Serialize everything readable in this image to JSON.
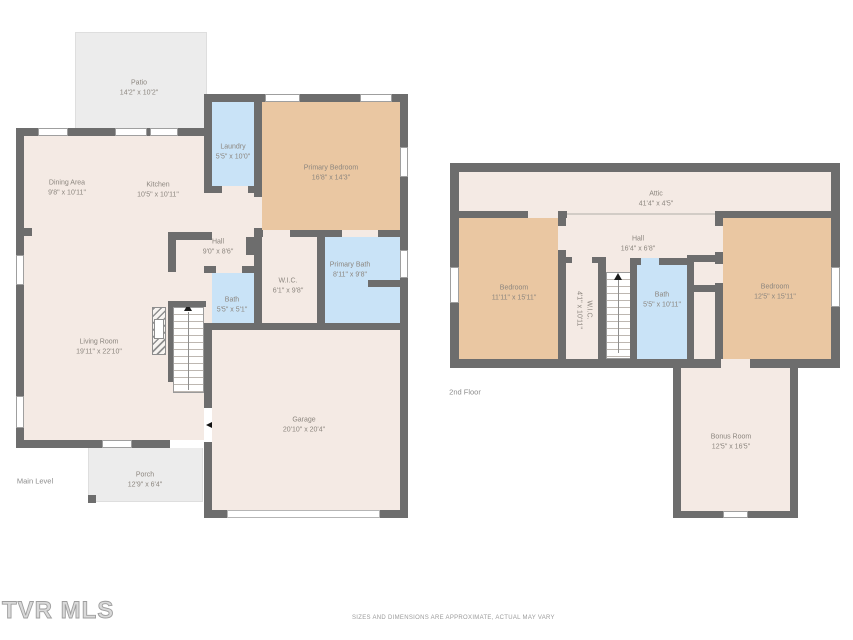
{
  "page": {
    "watermark": "TVR MLS",
    "disclaimer": "SIZES AND DIMENSIONS ARE APPROXIMATE, ACTUAL MAY VARY"
  },
  "colors": {
    "wall": "#6d6d6d",
    "floor": "#f4eae4",
    "bedroom_tan": "#eac7a2",
    "bath_blue": "#c9e3f7",
    "outdoor_gray": "#ececec",
    "label_text": "#8c867f"
  },
  "main_level": {
    "label": "Main Level",
    "rooms": [
      {
        "name": "Patio",
        "dims": "14'2\" x 10'2\""
      },
      {
        "name": "Dining Area",
        "dims": "9'8\" x 10'11\""
      },
      {
        "name": "Kitchen",
        "dims": "10'5\" x 10'11\""
      },
      {
        "name": "Laundry",
        "dims": "5'5\" x 10'0\""
      },
      {
        "name": "Primary Bedroom",
        "dims": "16'8\" x 14'3\""
      },
      {
        "name": "Hall",
        "dims": "9'0\" x 8'6\""
      },
      {
        "name": "W.I.C.",
        "dims": "6'1\" x 9'8\""
      },
      {
        "name": "Primary Bath",
        "dims": "8'11\" x 9'8\""
      },
      {
        "name": "Bath",
        "dims": "5'5\" x 5'1\""
      },
      {
        "name": "Living Room",
        "dims": "19'11\" x 22'10\""
      },
      {
        "name": "Garage",
        "dims": "20'10\" x 20'4\""
      },
      {
        "name": "Porch",
        "dims": "12'9\" x 6'4\""
      }
    ]
  },
  "second_floor": {
    "label": "2nd Floor",
    "rooms": [
      {
        "name": "Attic",
        "dims": "41'4\" x 4'5\""
      },
      {
        "name": "Hall",
        "dims": "16'4\" x 6'8\""
      },
      {
        "name": "Bedroom",
        "dims": "11'11\" x 15'11\""
      },
      {
        "name": "W.I.C.",
        "dims": "4'1\" x 10'11\""
      },
      {
        "name": "Bath",
        "dims": "5'5\" x 10'11\""
      },
      {
        "name": "Bedroom",
        "dims": "12'5\" x 15'11\""
      },
      {
        "name": "Bonus Room",
        "dims": "12'5\" x 16'5\""
      }
    ]
  }
}
